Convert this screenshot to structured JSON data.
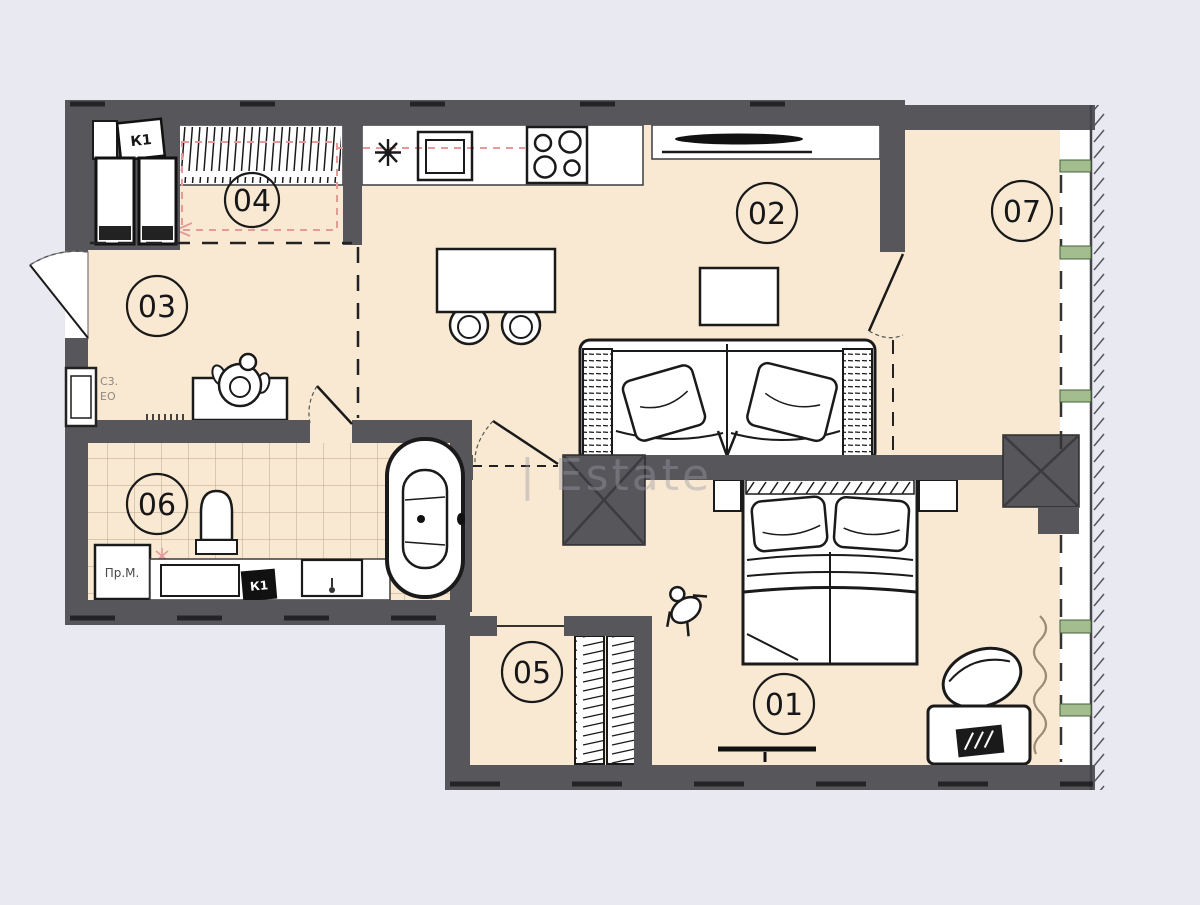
{
  "title": "Apartment floor plan",
  "watermark": {
    "text": "| Estate"
  },
  "rooms": {
    "r01": {
      "label": "01"
    },
    "r02": {
      "label": "02"
    },
    "r03": {
      "label": "03"
    },
    "r04": {
      "label": "04"
    },
    "r05": {
      "label": "05"
    },
    "r06": {
      "label": "06"
    },
    "r07": {
      "label": "07"
    }
  },
  "labels": {
    "shaft_top": "К1",
    "shaft_bath": "К1",
    "washing_machine": "Пр.М.",
    "panel_line1": "С3.",
    "panel_line2": "ЕО"
  },
  "colors": {
    "background": "#e9eaf1",
    "wall": "#57565a",
    "floor": "#f9e9d2",
    "line": "#1a1a1a",
    "tile_line": "#c3b296",
    "accent_pink": "#e59a9a",
    "accent_green": "#a4bd8f",
    "watermark": "#9a9aa6"
  }
}
